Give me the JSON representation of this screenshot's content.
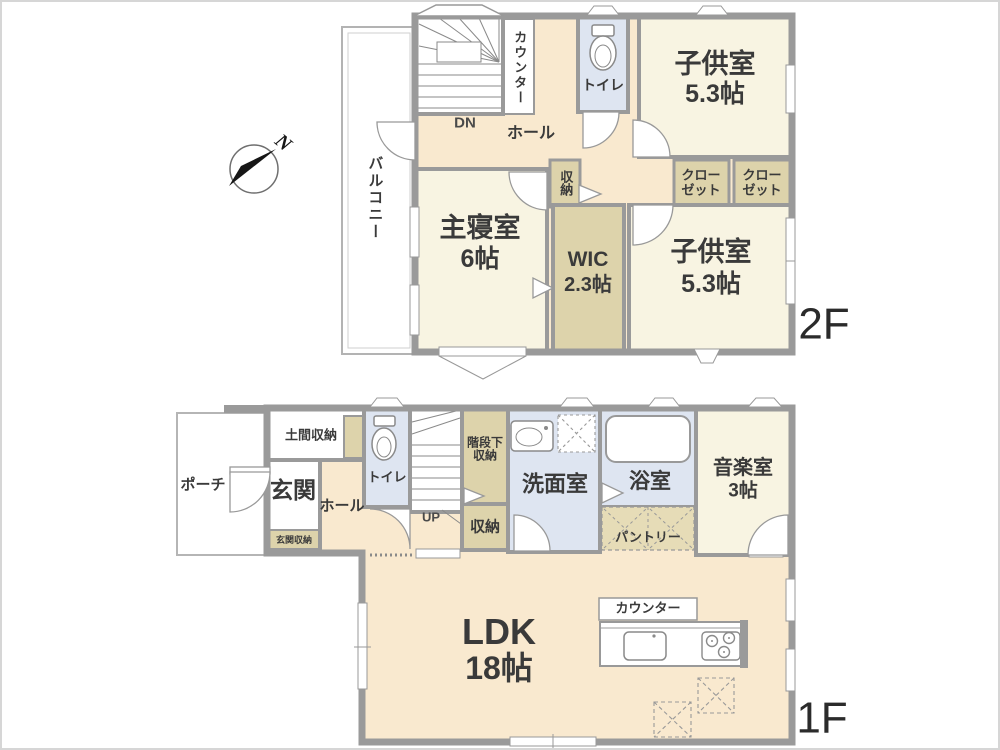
{
  "meta": {
    "floor2_label": "2F",
    "floor1_label": "1F",
    "compass_n": "N"
  },
  "colors": {
    "wall": "#9a9a9a",
    "room_cream": "#f8f4e2",
    "hall_peach": "#f9e9cf",
    "storage_tan": "#ddd3ab",
    "wet_blue": "#dee5f1",
    "text": "#3a3a3a"
  },
  "floor2": {
    "balcony": "バルコニー",
    "counter": "カウンター",
    "dn": "DN",
    "hall": "ホール",
    "toilet": "トイレ",
    "kids_room_top": {
      "name": "子供室",
      "size": "5.3帖"
    },
    "storage": "収納",
    "closet1": {
      "line1": "クロー",
      "line2": "ゼット"
    },
    "closet2": {
      "line1": "クロー",
      "line2": "ゼット"
    },
    "master": {
      "name": "主寝室",
      "size": "6帖"
    },
    "wic": {
      "name": "WIC",
      "size": "2.3帖"
    },
    "kids_room_bottom": {
      "name": "子供室",
      "size": "5.3帖"
    }
  },
  "floor1": {
    "porch": "ポーチ",
    "doma_storage": "土間収納",
    "entrance": "玄関",
    "entrance_storage": "玄関収納",
    "hall": "ホール",
    "toilet": "トイレ",
    "under_stair_storage": {
      "line1": "階段下",
      "line2": "収納"
    },
    "up": "UP",
    "storage": "収納",
    "washroom": "洗面室",
    "bathroom": "浴室",
    "pantry": "パントリー",
    "music_room": {
      "name": "音楽室",
      "size": "3帖"
    },
    "ldk": {
      "name": "LDK",
      "size": "18帖"
    },
    "counter": "カウンター"
  }
}
